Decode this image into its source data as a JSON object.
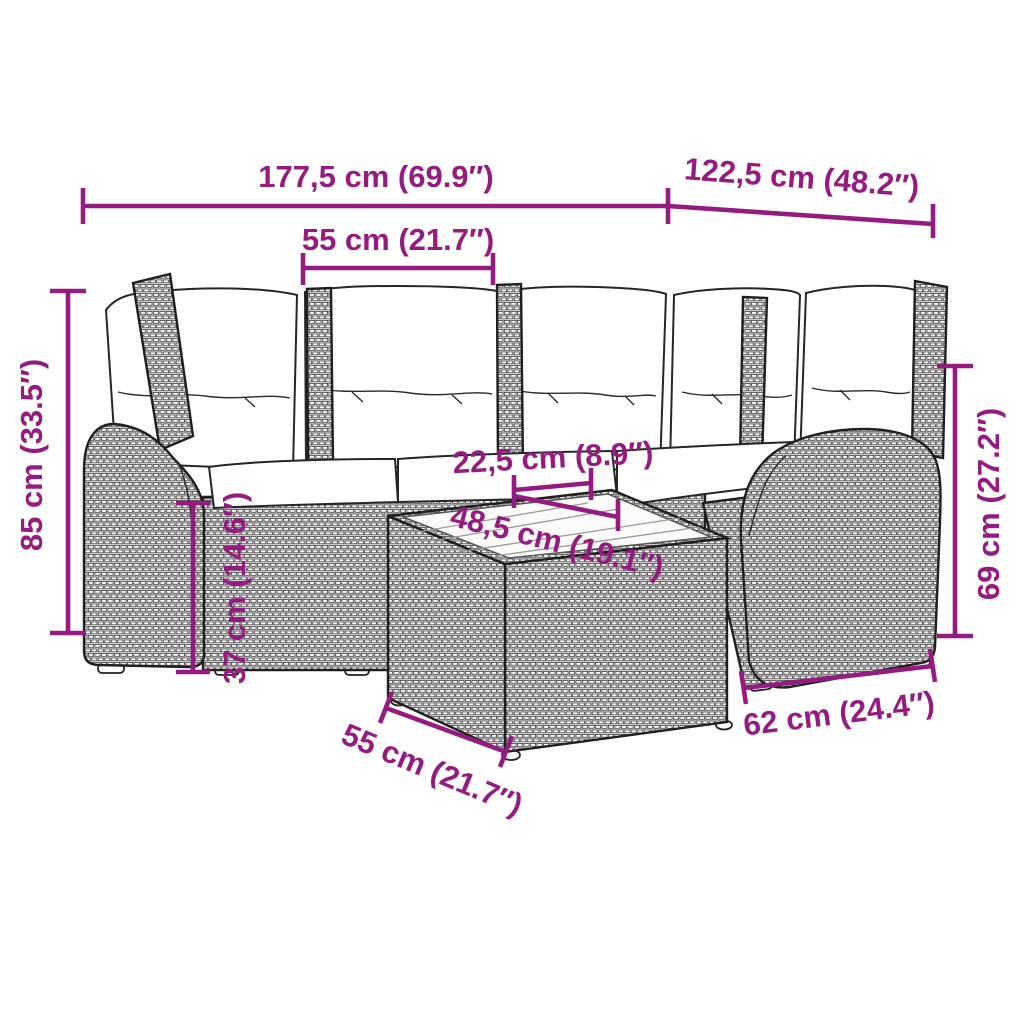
{
  "colors": {
    "dimension": "#951B81",
    "line_art": "#1f1f1f",
    "background": "#ffffff"
  },
  "diagram": {
    "subject": "rattan corner sofa set with cushions and glass-top coffee table"
  },
  "dims": {
    "total_width": "177,5 cm (69.9″)",
    "right_depth": "122,5 cm (48.2″)",
    "seat_width_top": "55 cm (21.7″)",
    "overall_height": "85 cm (33.5″)",
    "tabletop_border": "22,5 cm (8.9″)",
    "tabletop_glass": "48,5 cm (19.1″)",
    "seat_height": "37 cm (14.6″)",
    "armrest_height": "69 cm (27.2″)",
    "right_section_width": "62 cm (24.4″)",
    "table_width": "55 cm (21.7″)"
  }
}
